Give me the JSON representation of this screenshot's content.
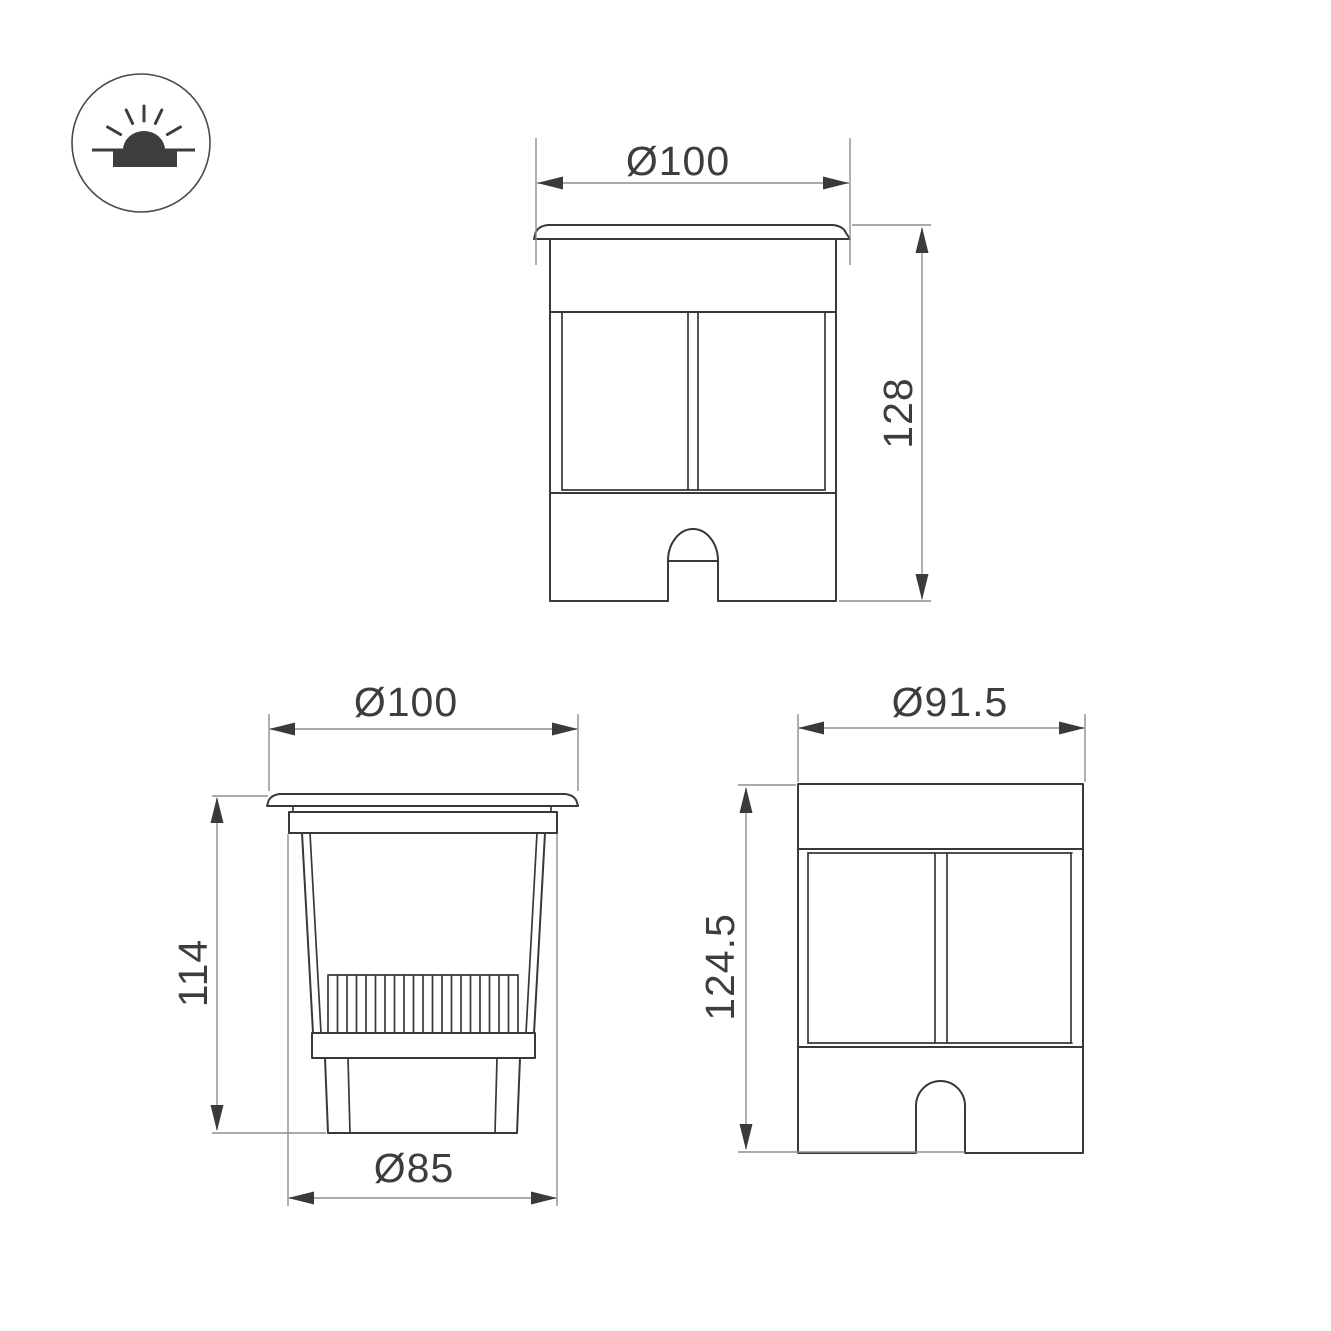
{
  "icon": {
    "name": "recessed-ground-luminaire-symbol",
    "description": "circle containing in-ground recessed light pictogram with light rays"
  },
  "views": {
    "front": {
      "name": "front view (installed, with trim flange)",
      "width_label": "Ø100",
      "height_label": "128"
    },
    "section": {
      "name": "side section view (body below flange)",
      "width_label": "Ø100",
      "height_label": "114",
      "base_label": "Ø85"
    },
    "rear": {
      "name": "housing view (without flange)",
      "width_label": "Ø91.5",
      "height_label": "124.5"
    }
  },
  "colors": {
    "background": "#ffffff",
    "outline": "#383838",
    "dimension_lines": "#8e8e8e",
    "text": "#3d3d3d"
  }
}
